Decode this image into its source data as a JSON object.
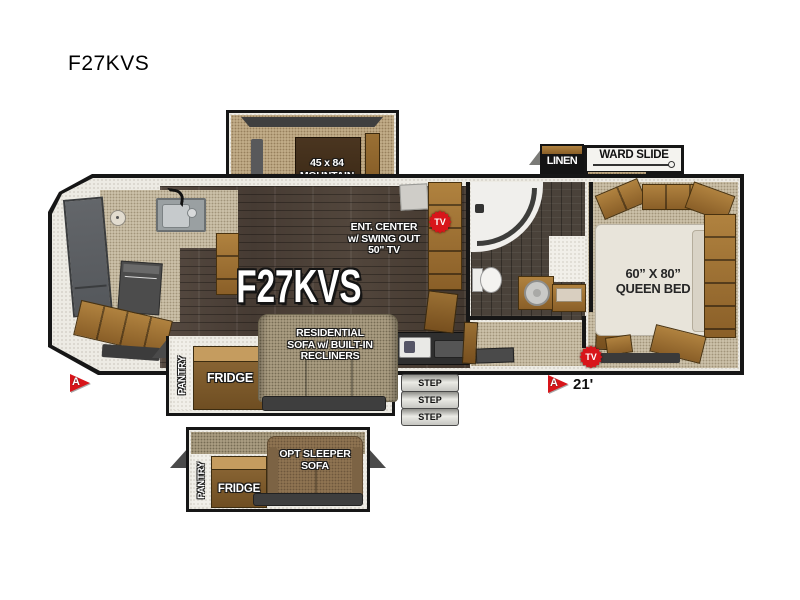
{
  "page": {
    "title": "F27KVS"
  },
  "plan": {
    "model": "F27KVS",
    "length": "21'",
    "marker": "A",
    "tv": "TV",
    "door_marker": "›",
    "dinette": {
      "l1": "45 x 84",
      "l2": "MOUNTAIN",
      "l3": "DINETTE"
    },
    "ent": {
      "l1": "ENT. CENTER",
      "l2": "w/ SWING OUT",
      "l3": "50\" TV"
    },
    "sofa": {
      "l1": "RESIDENTIAL",
      "l2": "SOFA w/ BUILT-IN",
      "l3": "RECLINERS"
    },
    "bed": {
      "l1": "60” X 80”",
      "l2": "QUEEN BED"
    },
    "linen": "LINEN",
    "ward": "WARD SLIDE",
    "pantry": "PANTRY",
    "fridge": "FRIDGE",
    "opt": {
      "l1": "OPT SLEEPER",
      "l2": "SOFA"
    },
    "steps": [
      "STEP",
      "STEP",
      "STEP"
    ],
    "colors": {
      "outline": "#161616",
      "red": "#d8151a",
      "wood": "#9c7440",
      "floor_wood": "#4c4138",
      "carpet": "#cabfa7",
      "wall": "#edebe4"
    }
  }
}
